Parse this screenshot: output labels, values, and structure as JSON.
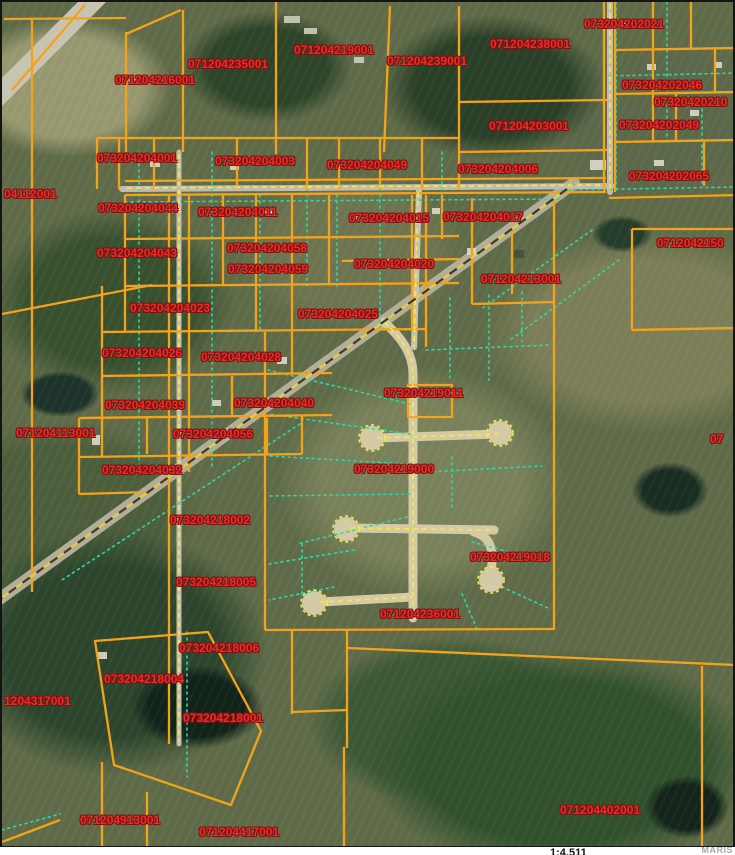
{
  "frame": {
    "scale_text": "1:4,511",
    "watermark": "MARIS"
  },
  "map": {
    "colors": {
      "parcel_line": "#f5a21b",
      "parcel_label": "#ee2b26",
      "road_centerline": "#f4e84f",
      "lot_line": "#2fd7a6",
      "highway_dash_dark": "#3c3c2c"
    },
    "parcel_labels": [
      {
        "text": "071204216001",
        "x": 113,
        "y": 72
      },
      {
        "text": "071204235001",
        "x": 186,
        "y": 56
      },
      {
        "text": "071204219001",
        "x": 292,
        "y": 42
      },
      {
        "text": "071204239001",
        "x": 385,
        "y": 53
      },
      {
        "text": "071204238001",
        "x": 488,
        "y": 36
      },
      {
        "text": "073204202021",
        "x": 582,
        "y": 16
      },
      {
        "text": "071204203001",
        "x": 487,
        "y": 118
      },
      {
        "text": "073204202046",
        "x": 620,
        "y": 77
      },
      {
        "text": "07320420210",
        "x": 652,
        "y": 94
      },
      {
        "text": "073204202049",
        "x": 617,
        "y": 117
      },
      {
        "text": "073204202065",
        "x": 627,
        "y": 168
      },
      {
        "text": "073204204006",
        "x": 456,
        "y": 161
      },
      {
        "text": "073204204001",
        "x": 95,
        "y": 150
      },
      {
        "text": "073204204003",
        "x": 213,
        "y": 153
      },
      {
        "text": "073204204049",
        "x": 325,
        "y": 157
      },
      {
        "text": "073204204044",
        "x": 96,
        "y": 200
      },
      {
        "text": "073204204011",
        "x": 196,
        "y": 204
      },
      {
        "text": "073204204015",
        "x": 347,
        "y": 210
      },
      {
        "text": "073204204017",
        "x": 441,
        "y": 209
      },
      {
        "text": "073204204043",
        "x": 95,
        "y": 245
      },
      {
        "text": "073204204058",
        "x": 225,
        "y": 240
      },
      {
        "text": "073204204059",
        "x": 226,
        "y": 261
      },
      {
        "text": "073204204020",
        "x": 352,
        "y": 256
      },
      {
        "text": "071204213001",
        "x": 479,
        "y": 271
      },
      {
        "text": "0712042150",
        "x": 655,
        "y": 235
      },
      {
        "text": "073204204023",
        "x": 128,
        "y": 300
      },
      {
        "text": "073204204025",
        "x": 296,
        "y": 306
      },
      {
        "text": "073204204026",
        "x": 100,
        "y": 345
      },
      {
        "text": "073204204028",
        "x": 199,
        "y": 349
      },
      {
        "text": "073204204039",
        "x": 103,
        "y": 397
      },
      {
        "text": "073204204040",
        "x": 232,
        "y": 395
      },
      {
        "text": "073204204056",
        "x": 171,
        "y": 426
      },
      {
        "text": "073204204032",
        "x": 100,
        "y": 462
      },
      {
        "text": "073204219011",
        "x": 382,
        "y": 385
      },
      {
        "text": "073204219000",
        "x": 352,
        "y": 461
      },
      {
        "text": "04112001",
        "x": 2,
        "y": 186
      },
      {
        "text": "071204113001",
        "x": 14,
        "y": 425
      },
      {
        "text": "073204218002",
        "x": 168,
        "y": 512
      },
      {
        "text": "073204218005",
        "x": 174,
        "y": 574
      },
      {
        "text": "073204219018",
        "x": 468,
        "y": 549
      },
      {
        "text": "071204236001",
        "x": 378,
        "y": 606
      },
      {
        "text": "073204218006",
        "x": 177,
        "y": 640
      },
      {
        "text": "073204218004",
        "x": 102,
        "y": 671
      },
      {
        "text": "1204317001",
        "x": 2,
        "y": 693
      },
      {
        "text": "073204218001",
        "x": 181,
        "y": 710
      },
      {
        "text": "071204913001",
        "x": 78,
        "y": 812
      },
      {
        "text": "071204417001",
        "x": 197,
        "y": 824
      },
      {
        "text": "071204402001",
        "x": 558,
        "y": 802
      },
      {
        "text": "07",
        "x": 708,
        "y": 431
      }
    ]
  }
}
